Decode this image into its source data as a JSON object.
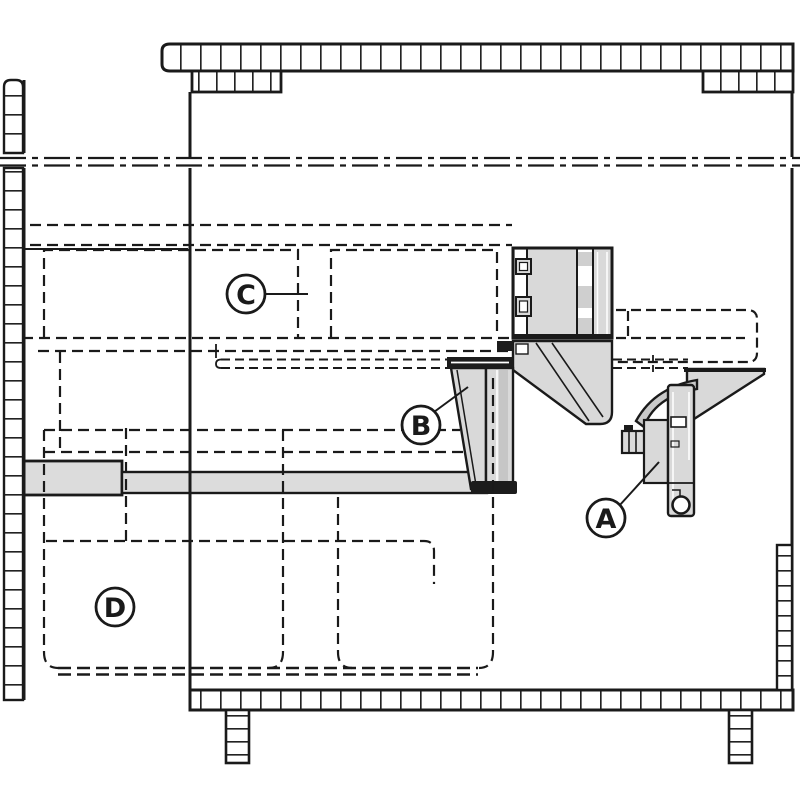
{
  "diagram": {
    "kind": "technical-drawing",
    "description": "Side cross-section of a cabinet with worktop, pull-out frame, waste-bin outlines and mounting hardware",
    "callouts": [
      {
        "id": "A",
        "letter": "A"
      },
      {
        "id": "B",
        "letter": "B"
      },
      {
        "id": "C",
        "letter": "C"
      },
      {
        "id": "D",
        "letter": "D"
      }
    ],
    "colors": {
      "line": "#1a1a1a",
      "fill_light": "#d9d9d9",
      "fill_mid": "#c6c6c6",
      "fill_dark": "#1c1c1c",
      "background": "#ffffff"
    }
  }
}
